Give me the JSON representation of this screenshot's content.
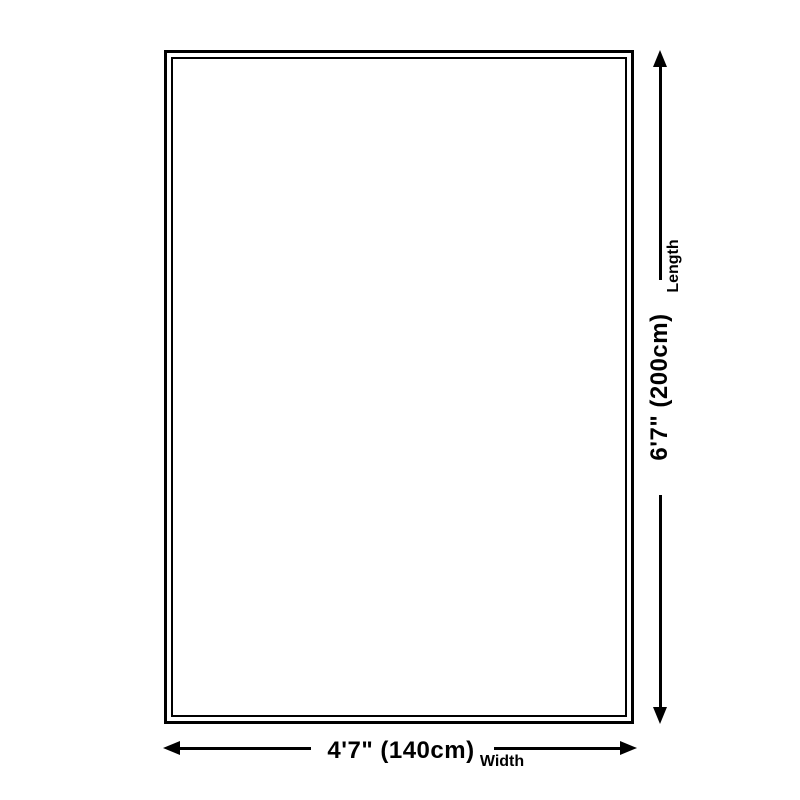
{
  "diagram": {
    "type": "product-dimension-diagram",
    "width_dimension": {
      "value": "4'7\" (140cm)",
      "label": "Width"
    },
    "length_dimension": {
      "value": "6'7\" (200cm)",
      "label": "Length"
    },
    "colors": {
      "line": "#000000",
      "background": "#ffffff"
    }
  }
}
